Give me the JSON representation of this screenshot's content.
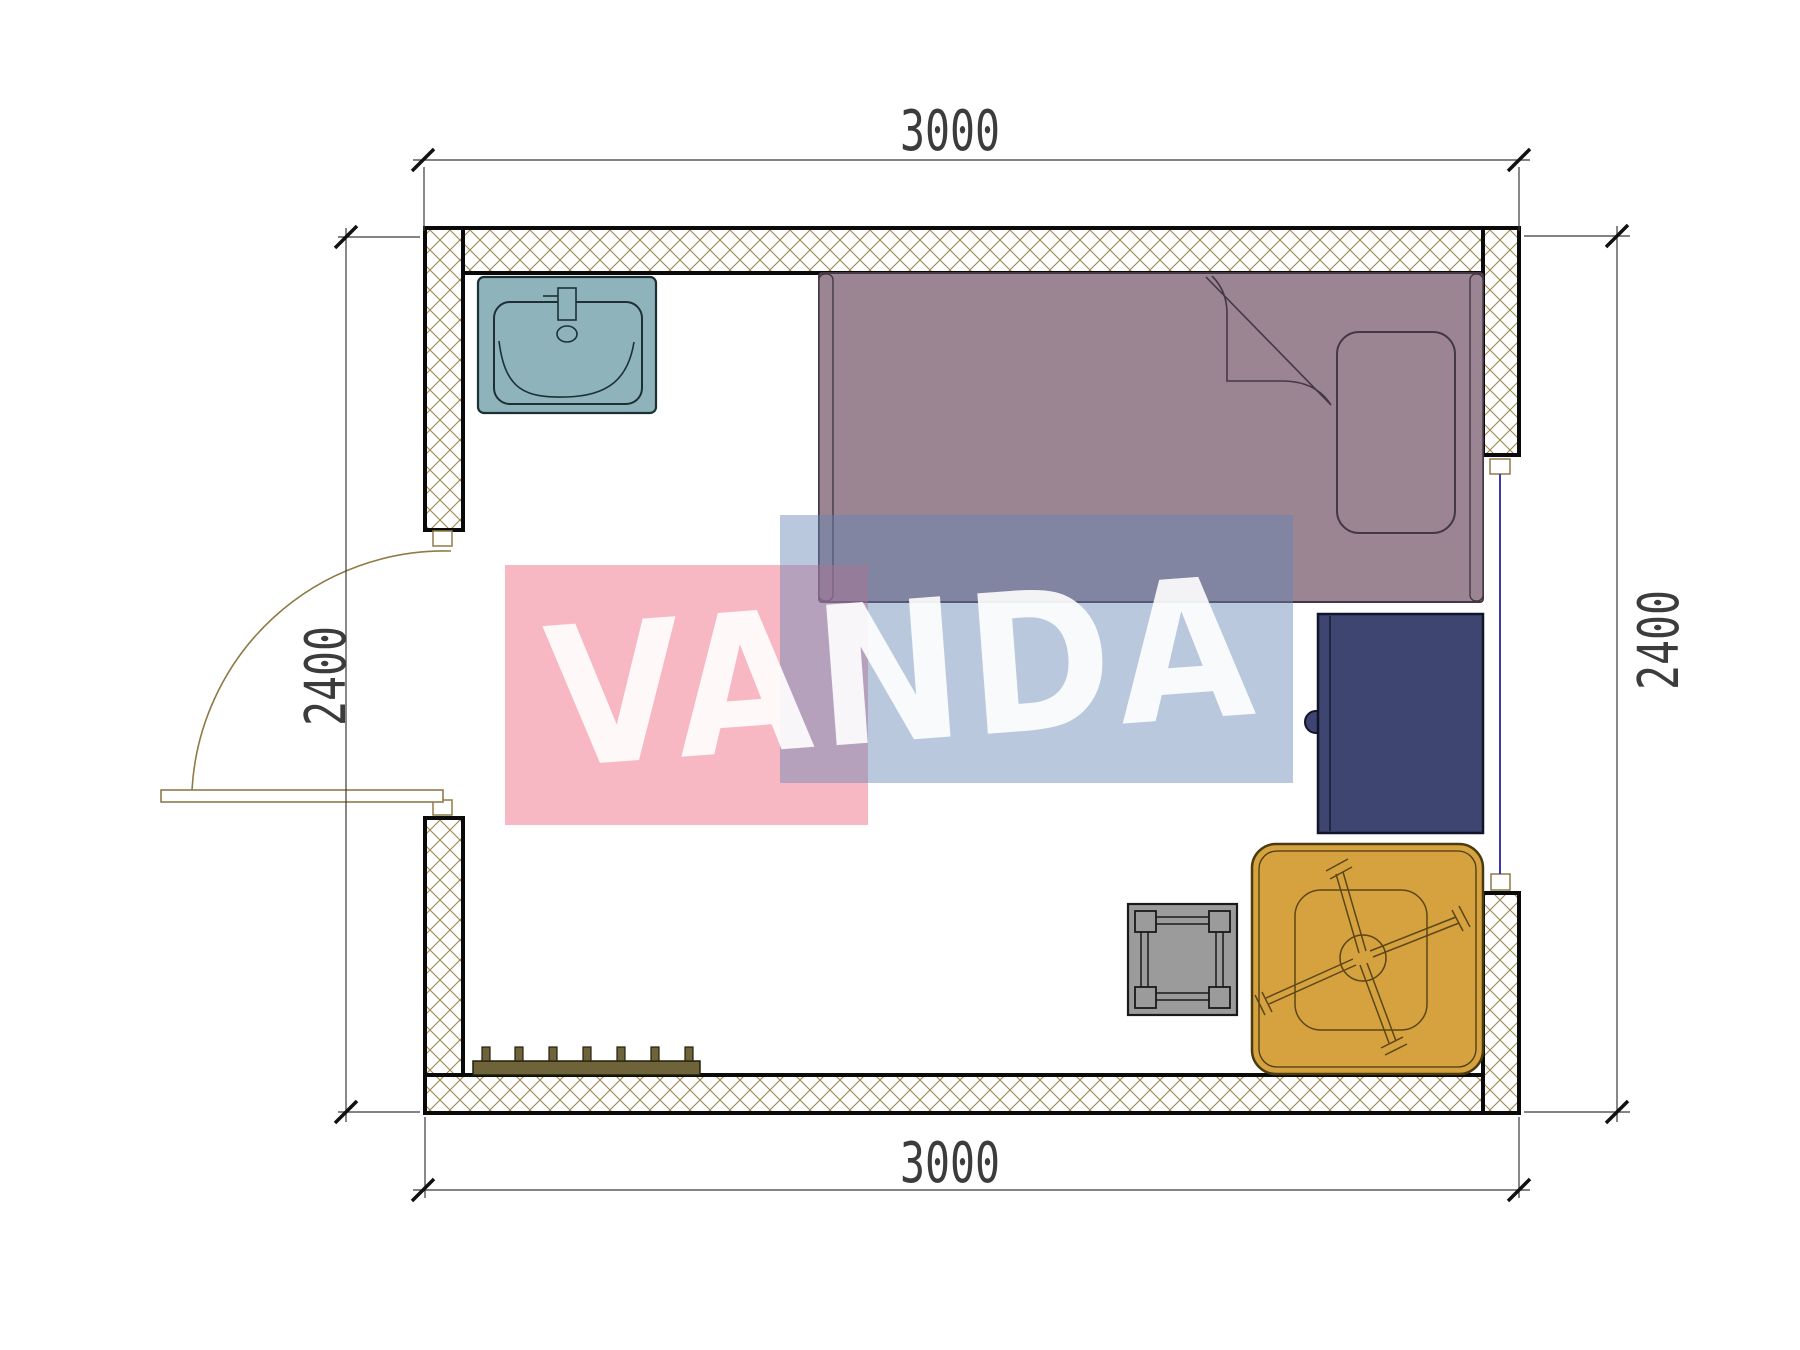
{
  "drawing": {
    "type": "architectural-floor-plan",
    "watermark": {
      "text": "VANDA"
    },
    "dimensions": {
      "top": "3000",
      "bottom": "3000",
      "left": "2400",
      "right": "2400"
    },
    "furniture": [
      "sink",
      "single-bed",
      "pillow",
      "wardrobe",
      "low-table",
      "stool",
      "radiator-bench"
    ],
    "openings": [
      "door-left-wall",
      "window-right-wall"
    ],
    "colors": {
      "wall_hatch": "#9c8750",
      "wall_outline": "#0a0a0a",
      "sink": "#8fb3ba",
      "sink_outline": "#1d3036",
      "bed": "#9c8593",
      "bed_outline": "#443845",
      "wardrobe": "#3d4570",
      "wardrobe_outline": "#10152b",
      "table": "#d5a23f",
      "table_outline": "#4a3a10",
      "stool": "#9b9b9b",
      "radiator": "#6e6339",
      "window_glass": "#3a3ab0",
      "door_swing": "#8f7b48",
      "watermark_pink": "rgba(238,98,124,0.45)",
      "watermark_blue": "rgba(100,133,180,0.45)",
      "watermark_text": "rgba(255,255,255,0.9)",
      "dimension_text": "#3c3c3c",
      "dimension_line": "#3a3a3a",
      "dimension_tick": "#111111"
    }
  }
}
